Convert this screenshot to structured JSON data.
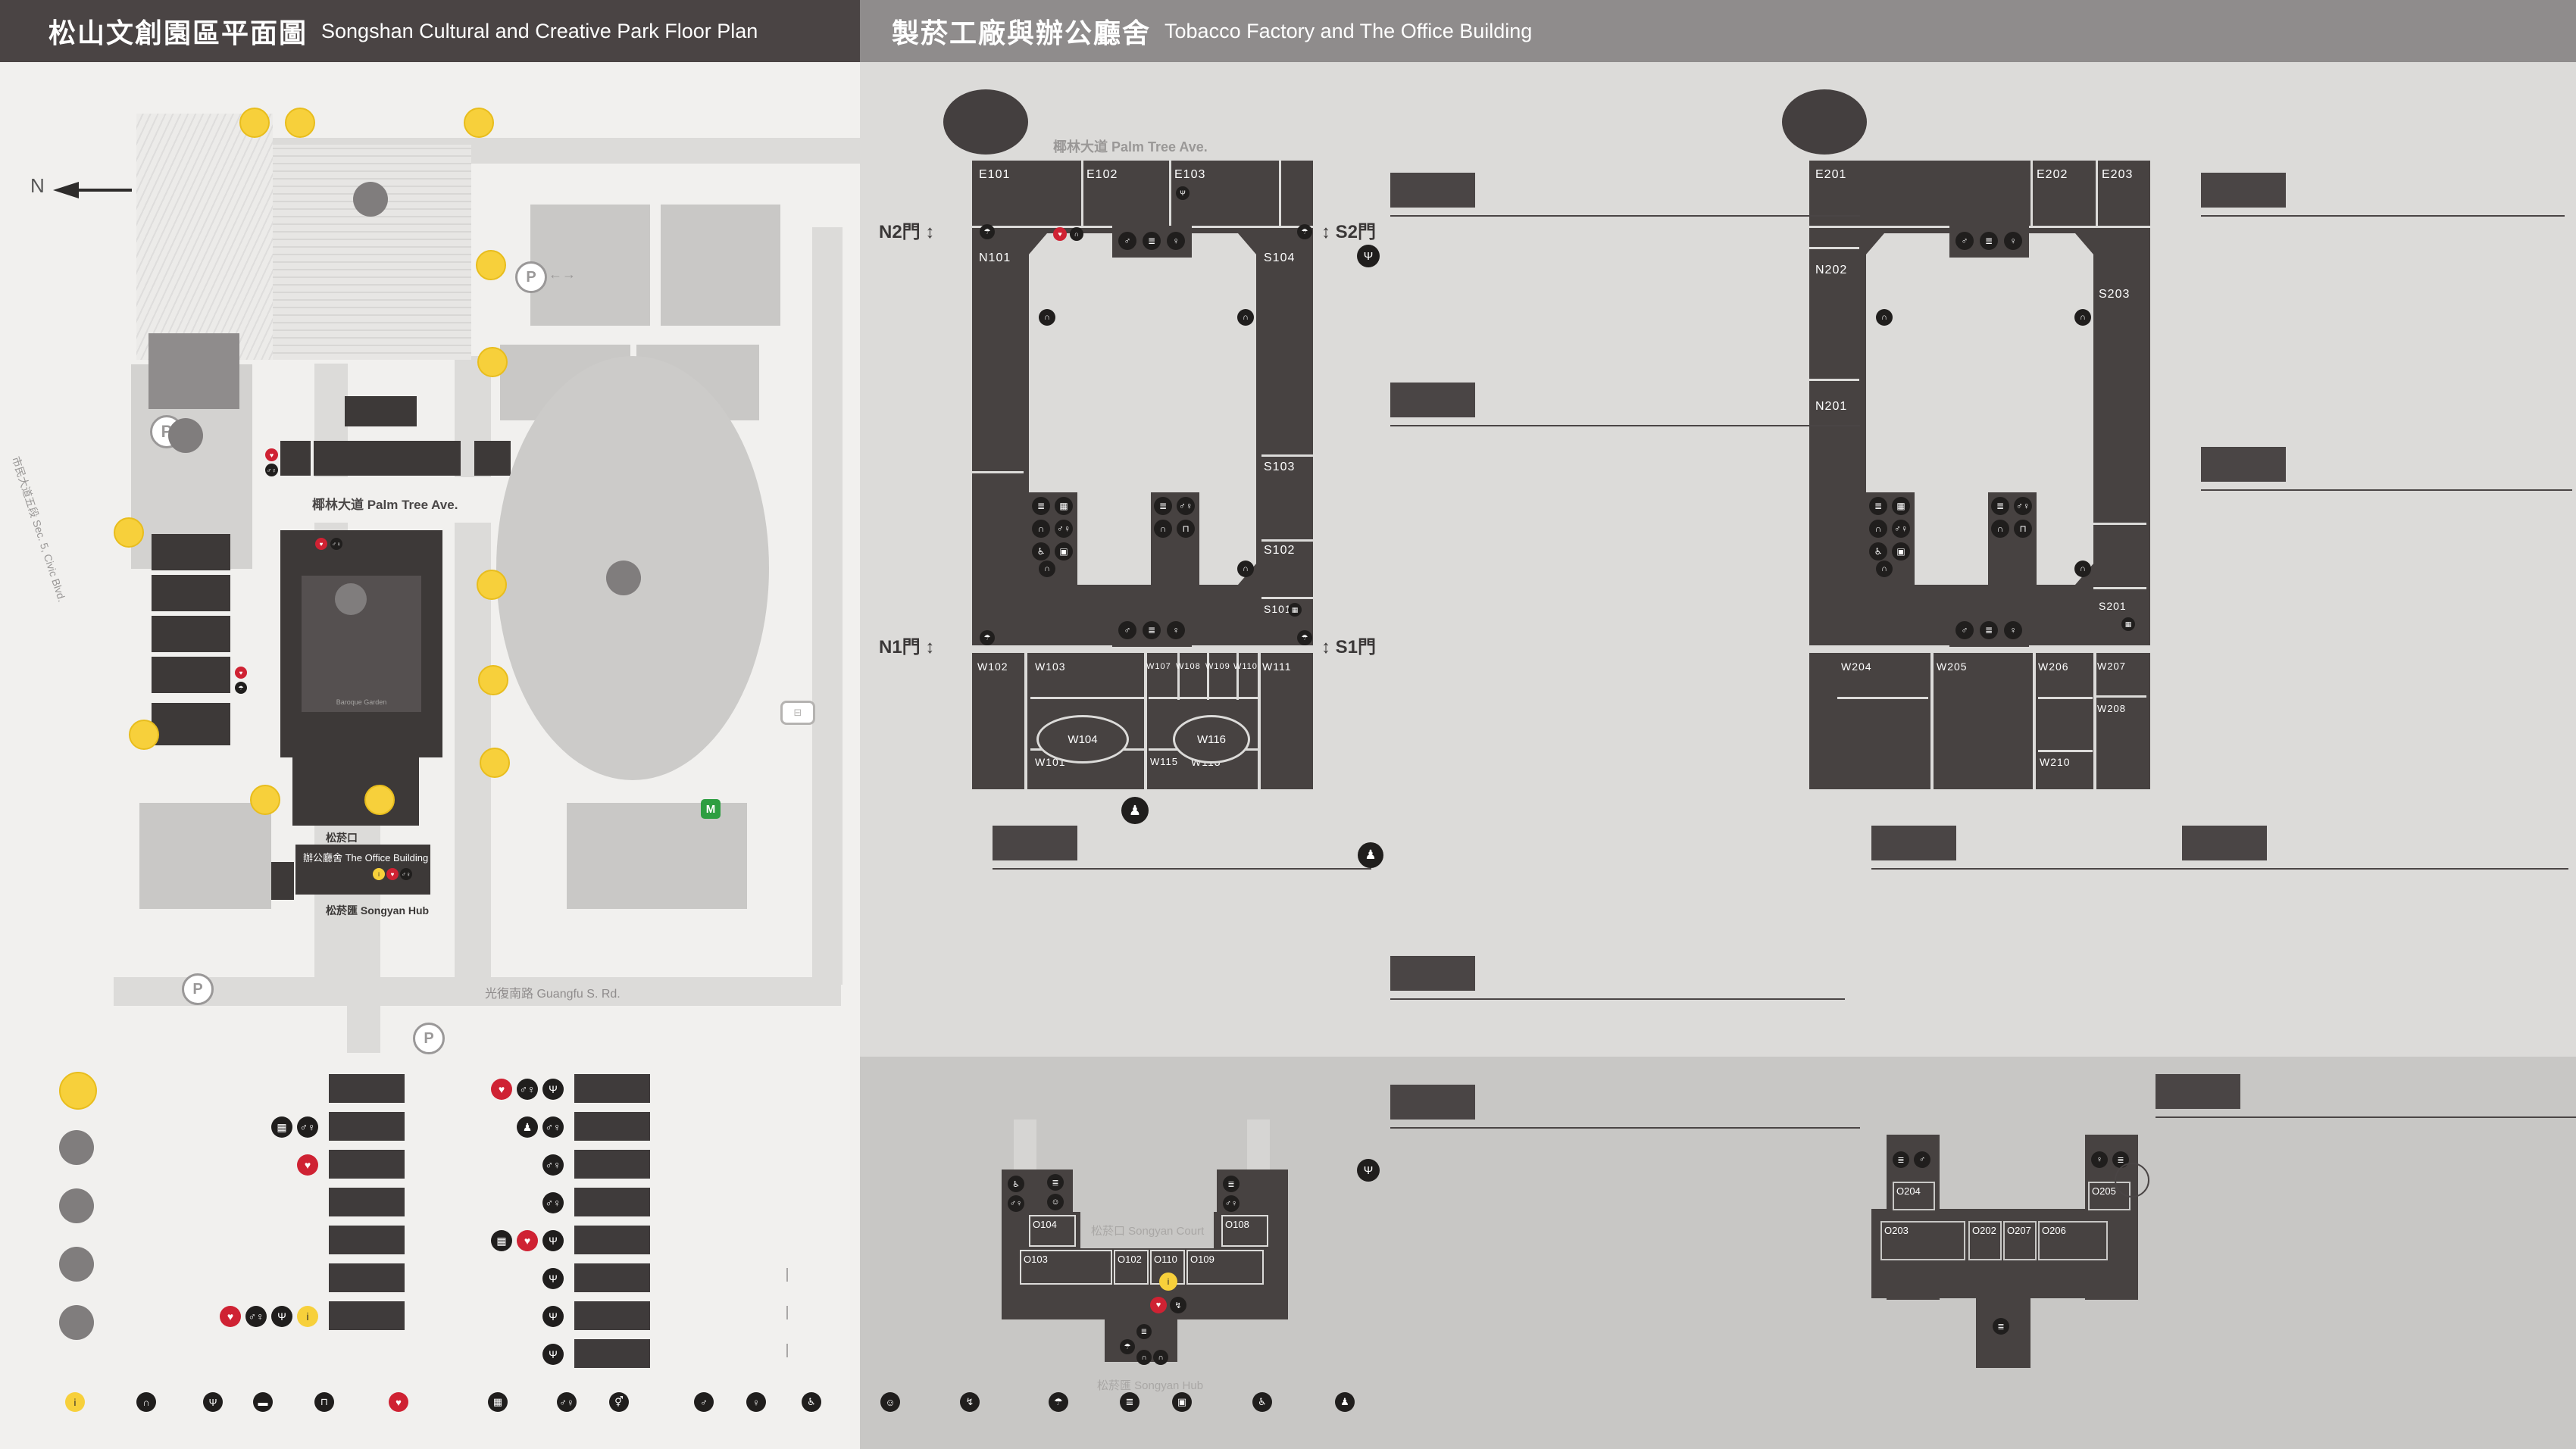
{
  "header": {
    "left": {
      "zh": "松山文創園區平面圖",
      "en": "Songshan Cultural and Creative Park Floor Plan"
    },
    "right": {
      "zh": "製菸工廠與辦公廳舍",
      "en": "Tobacco Factory and The Office Building"
    }
  },
  "park_map": {
    "north": "N",
    "labels": {
      "railway_museum": {
        "zh": "國家鐵道博物館",
        "en": "National Railway Museum"
      },
      "eslite_hotel": {
        "zh": "誠品行旅",
        "en": "eslite hotel"
      },
      "taipei_new_horizon": {
        "zh": "臺北文創大樓",
        "en": "Taipei New Horizon"
      },
      "eslite_spectrum": {
        "zh": "誠品生活松菸",
        "en": "eslite spectrum Songyan Store"
      },
      "cultural_plaza": {
        "zh": "文化廣場",
        "en": "Cultural Plaza"
      },
      "cc_blvd": {
        "zh": "文創大街",
        "en": "Cultural & Creative Blvd."
      },
      "palm_ave": {
        "zh": "椰林大道",
        "en": "Palm Tree Ave."
      },
      "maple_ave": {
        "zh": "楓香大道",
        "en": "Maple Tree Ave."
      },
      "songyan_ave": {
        "zh": "松菸大道",
        "en": "Songyan Ave."
      },
      "guangfu": {
        "zh": "光復南路",
        "en": "Guangfu S. Rd."
      },
      "zhongxiao": {
        "zh": "忠孝東路四段",
        "en": "Sec. 4, Zhongxiao E. Rd."
      },
      "civic": {
        "zh": "市民大道五段",
        "en": "Sec. 5, Civic Blvd."
      },
      "yanchang": {
        "zh": "菸廠路",
        "en": "Yanchang Rd."
      },
      "pond": {
        "zh": "生態景觀池",
        "en": "Ecological Pond"
      },
      "dome": {
        "zh": "臺北大巨蛋",
        "en": "Taipei Dome"
      },
      "gov1": {
        "zh": "內政部營建署聯合辦公大樓"
      },
      "gov2": {
        "zh": "財政部財政資訊中心"
      },
      "intercontinental": {
        "zh": "臺北洲際酒店",
        "en": "InterContinental Taipei"
      },
      "dome_center": {
        "zh": "巨蛋國際中心",
        "en": "Taipei Dome Int'l Center"
      },
      "showtime": {
        "zh": "秀泰影城",
        "en": "Showtime Cinemas"
      },
      "garden_city": {
        "zh": "遠東Garden City"
      },
      "mrt": {
        "zh": "捷運國父紀念館站",
        "en": "Sun Yat-sen Memorial Hall Station"
      },
      "park_center": {
        "zh": "松山文創園區",
        "en1": "Songshan Cultural and",
        "en2": "Creative Park"
      },
      "baroque": {
        "zh": "巴洛克花園",
        "en1": "Baroque",
        "en2": "Garden"
      },
      "songyan_court": {
        "zh": "松菸口",
        "en": "Songyan Court"
      },
      "office_building": {
        "zh": "辦公廳舍",
        "en": "The Office Building"
      },
      "songyan_hub": {
        "zh": "松菸匯",
        "en": "Songyan Hub"
      }
    },
    "buildings": {
      "a11": "A11",
      "a8": "A8",
      "a9": "A9",
      "a10": "A10",
      "a7e": "A7E",
      "a7n": "A7N",
      "a7s": "A7S",
      "a7w": "A7W",
      "a6": "A6",
      "a5": "A5",
      "a4": "A4",
      "a3": "A3",
      "a2": "A2",
      "a1": "A1",
      "a0": "A0",
      "a": "A",
      "b": "B",
      "c": "C",
      "d": "D"
    },
    "entrances": [
      "1",
      "2",
      "3",
      "4",
      "5",
      "6",
      "7",
      "8",
      "9",
      "10",
      "11",
      "12"
    ]
  },
  "legend_places": [
    {
      "mark": "N",
      "zh": "園區入口",
      "en": "Entrance"
    },
    {
      "mark": "A",
      "zh": "松山文創園區",
      "en": "Songshan Cultural and Creative Park"
    },
    {
      "mark": "B",
      "zh": "臺北文創大樓",
      "en": "Taipei New Horizon"
    },
    {
      "mark": "C",
      "zh": "生態景觀池",
      "en": "Ecological Pond"
    },
    {
      "mark": "D",
      "zh": "臺北大巨蛋",
      "en": "Taipei Dome"
    }
  ],
  "legend_buildings_col1": [
    {
      "code": "A0",
      "zh": "檢查室",
      "en": "Inspection Room",
      "icons": []
    },
    {
      "code": "A1",
      "zh": "1號倉庫",
      "en": "Warehouse No. 1",
      "icons": [
        "baggage-lockers",
        "toilet"
      ]
    },
    {
      "code": "A2",
      "zh": "2號倉庫",
      "en": "Warehouse No. 2",
      "icons": [
        "aed"
      ]
    },
    {
      "code": "A3",
      "zh": "3號倉庫",
      "en": "Warehouse No. 3",
      "icons": []
    },
    {
      "code": "A4",
      "zh": "4號倉庫",
      "en": "Warehouse No. 4",
      "icons": []
    },
    {
      "code": "A5",
      "zh": "5號倉庫",
      "en": "Warehouse No. 5",
      "icons": []
    },
    {
      "code": "A6",
      "zh": "辦公廳舍",
      "en": "The Office Building",
      "icons": [
        "aed",
        "toilet",
        "f-and-b",
        "information"
      ]
    }
  ],
  "legend_buildings_col2": [
    {
      "code": "A7 E",
      "zh": "製菸工廠｜東向",
      "en": "East Tobacco Factory",
      "icons": [
        "aed",
        "toilet",
        "f-and-b"
      ]
    },
    {
      "code": "A7 W",
      "zh": "製菸工廠｜西向",
      "en": "West Tobacco Factory",
      "icons": [
        "mini-trips",
        "toilet"
      ]
    },
    {
      "code": "A7 S",
      "zh": "製菸工廠｜南向",
      "en": "South Tobacco Factory",
      "icons": [
        "toilet"
      ]
    },
    {
      "code": "A7 N",
      "zh": "製菸工廠｜北向",
      "en": "North Tobacco Factory",
      "icons": [
        "toilet"
      ]
    },
    {
      "code": "A8",
      "zh": "全家便利商店",
      "en": "FamilyMart",
      "icons": [
        "baggage-lockers",
        "aed",
        "f-and-b"
      ]
    },
    {
      "code": "A9",
      "zh": "機器修理廠",
      "en": "The Machine Repair Plant",
      "note_zh": "ISLAND133 gonna'",
      "note_en": "ISLAND133 gonna'",
      "icons": [
        "f-and-b"
      ]
    },
    {
      "code": "A10",
      "zh": "鍋爐房",
      "en": "Boiler Room",
      "note_zh": "豆留文青",
      "note_en": "CAMA COFFEE ROASTERS",
      "icons": [
        "f-and-b"
      ]
    },
    {
      "code": "A11",
      "zh": "育嬰室",
      "en": "The Nursery Room",
      "note_zh": "光一 一個時間",
      "note_en": "GUANG YI IN TIME",
      "icons": [
        "f-and-b"
      ]
    }
  ],
  "facilities": [
    {
      "icon": "information",
      "zh": "服務中心",
      "en": "Information",
      "style": "yellow"
    },
    {
      "icon": "audio-tour",
      "zh": "語音導覽",
      "en": "Audio Tour"
    },
    {
      "icon": "f-and-b",
      "zh": "飲食",
      "en": "F&B"
    },
    {
      "icon": "smoking-area",
      "zh": "吸菸區",
      "en": "Smoking Area"
    },
    {
      "icon": "drinking-fountain",
      "zh": "飲水機",
      "en": "Drinking Fountain"
    },
    {
      "icon": "aed",
      "zh": "緊急心臟除顫器",
      "en": "AED",
      "style": "red"
    },
    {
      "icon": "baggage-lockers",
      "zh": "置物櫃",
      "en": "Baggage Lockers"
    },
    {
      "icon": "toilet",
      "zh": "廁所",
      "en": "Toilet"
    },
    {
      "icon": "all-gender-toilet",
      "zh": "性別友善廁所",
      "en": "All Gender Toilet"
    },
    {
      "icon": "mens-toilet",
      "zh": "男廁",
      "en": "Men's Toilet"
    },
    {
      "icon": "womens-toilet",
      "zh": "女廁",
      "en": "Women's Toilet"
    },
    {
      "icon": "accessible-toilet",
      "zh": "無障礙廁所",
      "en": "Accessible Toilet"
    },
    {
      "icon": "breastfeeding-room",
      "zh": "哺集乳室",
      "en": "Breastfeeding Room"
    },
    {
      "icon": "power-bank",
      "zh": "共享行動電源",
      "en": "Power Bank Rental"
    },
    {
      "icon": "umbrella-rental",
      "zh": "共享傘",
      "en": "Umbrella Rental"
    },
    {
      "icon": "stairs",
      "zh": "階梯",
      "en": "Stairs"
    },
    {
      "icon": "goods-elevator",
      "zh": "貨梯",
      "en": "Elevator For Goods"
    },
    {
      "icon": "accessible-elevator",
      "zh": "無障礙電梯",
      "en": "Accessible Elevator"
    },
    {
      "icon": "mini-trips",
      "zh": "臺北文化小旅行（松山菸廠廠歌石碑）",
      "en": "Mini Cultural Trips in Taipei (Stone Tablet of Songshan Tobacco Factory Anthem)"
    }
  ],
  "f1": {
    "badge": "1F",
    "street_top": {
      "zh": "椰林大道",
      "en": "Palm Tree Ave."
    },
    "street_left": {
      "zh": "文創大街",
      "en": "Cultural & Creative Blvd."
    },
    "street_right": {
      "zh": "楓香大道",
      "en": "Maple Tree Ave."
    },
    "center": "A7 製菸工廠",
    "gates": {
      "n2": "N2門",
      "s2": "S2門",
      "n1": "N1門",
      "s1": "S1門"
    },
    "map_rooms": [
      "E101",
      "E102",
      "E103",
      "N101",
      "S104",
      "S103",
      "S102",
      "S101",
      "W102",
      "W103",
      "W107",
      "W108",
      "W109",
      "W110",
      "W111",
      "W104",
      "W116",
      "W101",
      "W115",
      "W113"
    ],
    "sections": [
      {
        "code": "A7 E",
        "zh": "製菸工廠｜東向",
        "en": "East Tobacco Factory",
        "rooms": [
          {
            "code": "E101",
            "zh": "小智研發垃圾廚坊",
            "en": "MINIWIZ Trash Kitchen"
          },
          {
            "code": "E103",
            "zh": "松菸風格店家",
            "en": "Songyan Style Gallery",
            "icons": [
              "f-and-b"
            ]
          }
        ]
      },
      {
        "code": "A7 W",
        "zh": "製菸工廠｜西向",
        "en": "West Tobacco Factory",
        "rooms": [
          {
            "code": "W101–103\nW107.W115",
            "zh": "台灣設計館",
            "en": "Taiwan Design Museum"
          },
          {
            "code": "W104",
            "zh": "不只是圖書館",
            "en": "Not just Library"
          },
          {
            "code": "W108",
            "zh": "谷口写真企画室",
            "en": "no photo no life"
          },
          {
            "code": "W109",
            "zh": "以覺學",
            "en": "INTZUITION"
          },
          {
            "code": "W110",
            "zh": "TAIWANIZE"
          },
          {
            "code": "W111",
            "zh": "藝巷空間｜醫護室",
            "en": "Art Space D | Clinic"
          },
          {
            "code": "W113",
            "zh": "炊事場｜eyecandle",
            "en": "Catering Room | eyecandle"
          },
          {
            "code": "W116",
            "zh": "男澡堂",
            "en": "Male Bathhouse"
          }
        ]
      },
      {
        "code": "A7 S",
        "zh": "製菸工廠｜南向",
        "en": "South Tobacco Factory",
        "rooms": [
          {
            "code": "S101",
            "zh": "藝思空間",
            "en": "Art Space B"
          },
          {
            "code": "S102",
            "zh": "原樂好市–原民主題選品店",
            "en": "One Love Taipei–Indigenous Concept Store"
          },
          {
            "code": "S103",
            "zh": "藝異空間",
            "en": "Art Space A"
          },
          {
            "code": "S104",
            "zh": "南向製菸工廠",
            "en": "South Tobacco Factory"
          }
        ]
      },
      {
        "code": "A7 N",
        "zh": "製菸工廠｜北向",
        "en": "North Tobacco Factory",
        "rooms": [
          {
            "code": "N101",
            "zh": "北向製菸工廠",
            "en": "North Tobacco Factory"
          }
        ]
      }
    ],
    "court": {
      "code_zh": "松菸口",
      "code_en": "Songyan Court",
      "zh1": "臺北文化小旅行",
      "zh2": "（松山菸廠廠歌石碑）",
      "en1": "Mini Cultural Trips in Taipei",
      "en2": "(Stone Tablet of Songshan Tobacco Factory Anthem)"
    }
  },
  "a6f1": {
    "map_title": "A6 辦公廳舍",
    "court": {
      "zh": "松菸口",
      "en": "Songyan Court"
    },
    "hub": {
      "zh": "松菸匯",
      "en": "Songyan Hub"
    },
    "map_rooms": [
      "O104",
      "O103",
      "O102",
      "O110",
      "O109",
      "O108"
    ],
    "badge": "A6",
    "title_zh": "辦公廳舍 1F",
    "title_en": "The Office Building",
    "rooms": [
      {
        "code": "O102",
        "zh": "台灣設計館售票處",
        "en": "Taiwan Design Museum Ticket Counter"
      },
      {
        "code": "O103–104",
        "zh": "設計點",
        "en": "Design Pin"
      },
      {
        "code": "O108",
        "zh": "hof (EVERYDAY OBJECT)",
        "icons": [
          "f-and-b"
        ]
      },
      {
        "code": "O109",
        "zh": "松菸匯 辦公廳舍創意空間",
        "en": "Songyan Hub, SCCP Creative Space"
      },
      {
        "code": "O110",
        "zh": "松菸匯 松山文創園區服務中心",
        "en": "Songyan Hub, SCCP Information Center"
      }
    ]
  },
  "f2": {
    "badge": "2F",
    "center": "A7 製菸工廠",
    "map_rooms": [
      "E201",
      "E202",
      "E203",
      "N202",
      "N201",
      "S203",
      "S201",
      "W204",
      "W205",
      "W206",
      "W207",
      "W208",
      "W210"
    ],
    "sections": [
      {
        "code": "A7 E",
        "zh": "製菸工廠｜東向",
        "en": "East Tobacco Factory",
        "rooms": [
          {
            "code": "E201",
            "zh": "藝趣空間",
            "en": "Art Space C"
          },
          {
            "code": "E202",
            "zh": "文創交流中心",
            "en": "Exchange Center"
          },
          {
            "code": "E203",
            "zh": "XR沉浸玩家",
            "en": "XR PLAYHOUSE"
          }
        ]
      },
      {
        "code": "A7 W",
        "zh": "製菸工廠｜西向",
        "en": "West Tobacco Factory",
        "rooms": [
          {
            "code": "W204–206",
            "zh": "多功能展演廳",
            "en": "Multi-Purpose Hall"
          },
          {
            "code": "W207",
            "zh": "iF台北設計沙龍 / 藝符設計",
            "en": "iF Design Salon Taipei / iF DESIGN ASIA"
          },
          {
            "code": "W210",
            "zh": "松山文創園區營運中心",
            "zh2": "西向會議室",
            "en": "West Meeting Room SCCP"
          }
        ]
      },
      {
        "code": "A7 S",
        "zh": "製菸工廠｜南向",
        "en": "South Tobacco Factory",
        "rooms": [
          {
            "code": "S201",
            "zh": "台灣設計聯盟",
            "en": "Taiwan Design Alliance"
          },
          {
            "code": "S203",
            "zh": "松菸創作者工廠",
            "en": "Songyan Creative Hub"
          }
        ]
      },
      {
        "code": "A7 N",
        "zh": "製菸工廠｜北向",
        "en": "North Tobacco Factory",
        "rooms": [
          {
            "code": "N201",
            "zh": "台灣設計研究院 服務台",
            "en": "TDRI Information"
          },
          {
            "code": "N202",
            "zh": "台灣設計研究院 創意劇場",
            "en": "TDRI Creative Forum"
          }
        ]
      }
    ]
  },
  "a6f2": {
    "map_title": "A6 辦公廳舍",
    "map_rooms": [
      "O204",
      "O203",
      "O202",
      "O207",
      "O206",
      "O205"
    ],
    "badge": "A6",
    "title_zh": "辦公廳舍 2F",
    "title_en": "The Office Building",
    "rooms": [
      {
        "code": "O202",
        "zh": "松山文創園區營運中心202會議室",
        "en": "Meeting Room SCCP 202"
      },
      {
        "code": "O203",
        "zh": "台灣設計研究院201會議室",
        "en": "Meeting Room TDRI 201"
      },
      {
        "code": "O204",
        "zh": "台灣設計研究院202會議室",
        "en": "Meeting Room TDRI 202"
      },
      {
        "code": "O205",
        "zh": "松山文創園區營運中心201會議室",
        "en": "Meeting Room SCCP 201"
      },
      {
        "code": "O206–207",
        "zh": "台北市文化基金會",
        "zh2": "松山文創園區營運中心",
        "en": "Taipei Culture Foundation SCCP Management Center"
      },
      {
        "code": "O302",
        "prefix": "3F",
        "zh": "松山文創園區營運中心301會議室",
        "en": "Meeting Room SCCP 301"
      }
    ]
  }
}
